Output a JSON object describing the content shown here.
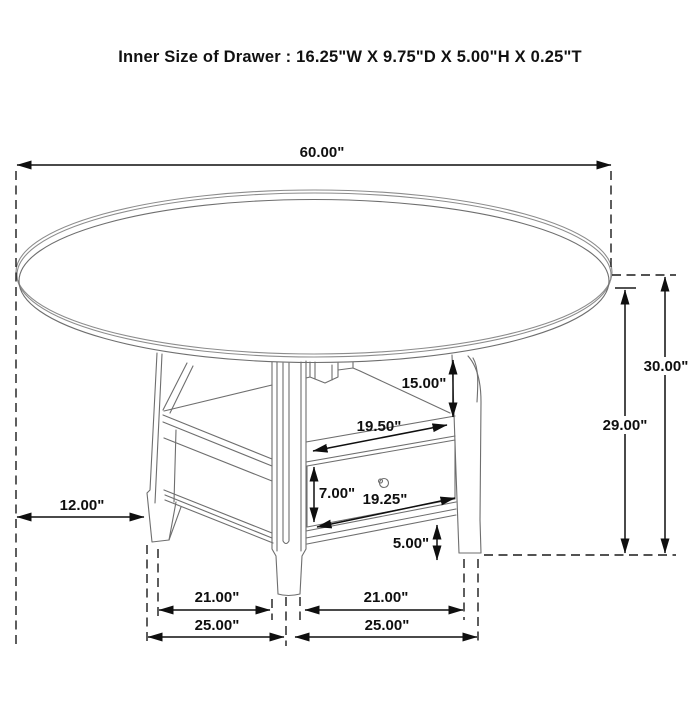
{
  "title": "Inner Size of Drawer : 16.25\"W X 9.75\"D X 5.00\"H X 0.25\"T",
  "diagram": {
    "line_color": "#0f0f0f",
    "furniture_line_color": "#6e6e6e",
    "background": "#ffffff"
  },
  "dimensions": {
    "table_diameter": "60.00\"",
    "table_height": "30.00\"",
    "underside_height": "29.00\"",
    "shelf_opening_height": "15.00\"",
    "shelf_width": "19.50\"",
    "drawer_face_height": "7.00\"",
    "drawer_width": "19.25\"",
    "bottom_rail_height": "5.00\"",
    "top_overhang": "12.00\"",
    "leg_spread_left": "21.00\"",
    "leg_spread_right": "21.00\"",
    "base_spread_left": "25.00\"",
    "base_spread_right": "25.00\""
  }
}
